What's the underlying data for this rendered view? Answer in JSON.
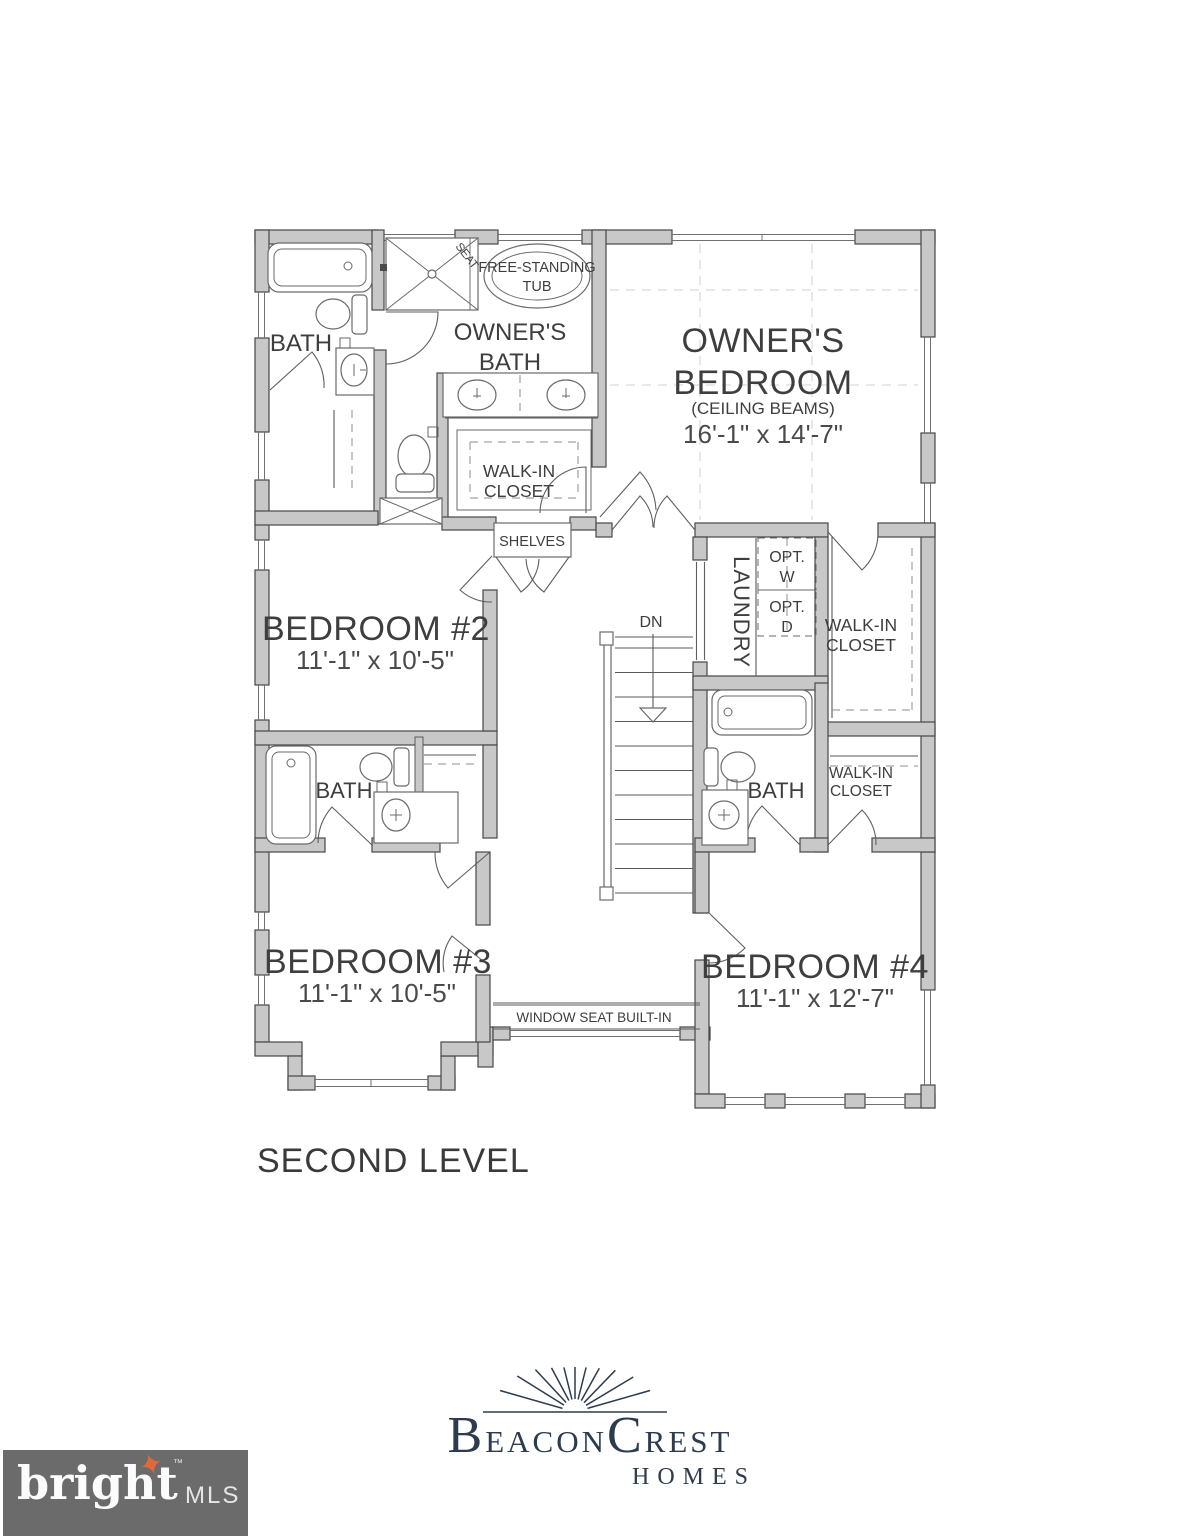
{
  "colors": {
    "ink": "#3e3e3e",
    "wall_fill": "#c8c8c8",
    "wall_stroke": "#474747",
    "logo_navy": "#2c3b4d",
    "mls_bar": "#6b6b6b",
    "mls_star": "#e0683c"
  },
  "plan": {
    "level_title": "SECOND LEVEL",
    "rooms": {
      "bath_top_left": {
        "label": "BATH"
      },
      "owners_bath": {
        "line1": "OWNER'S",
        "line2": "BATH",
        "tub_line1": "FREE-STANDING",
        "tub_line2": "TUB",
        "seat": "SEAT"
      },
      "owners_bedroom": {
        "line1": "OWNER'S",
        "line2": "BEDROOM",
        "note": "(CEILING BEAMS)",
        "dims": "16'-1\" x 14'-7\""
      },
      "owners_closet": {
        "line1": "WALK-IN",
        "line2": "CLOSET"
      },
      "shelves": {
        "label": "SHELVES"
      },
      "bedroom2": {
        "label": "BEDROOM #2",
        "dims": "11'-1\" x 10'-5\""
      },
      "laundry": {
        "label": "LAUNDRY",
        "opt_w_line1": "OPT.",
        "opt_w_line2": "W",
        "opt_d_line1": "OPT.",
        "opt_d_line2": "D"
      },
      "hall_closet": {
        "line1": "WALK-IN",
        "line2": "CLOSET"
      },
      "stairs": {
        "label": "DN"
      },
      "bath_right": {
        "label": "BATH"
      },
      "bedroom4_closet": {
        "line1": "WALK-IN",
        "line2": "CLOSET"
      },
      "bath_left": {
        "label": "BATH"
      },
      "bedroom3": {
        "label": "BEDROOM #3",
        "dims": "11'-1\" x 10'-5\""
      },
      "window_seat": {
        "label": "WINDOW SEAT BUILT-IN"
      },
      "bedroom4": {
        "label": "BEDROOM #4",
        "dims": "11'-1\" x 12'-7\""
      }
    }
  },
  "branding": {
    "beacon_initial": "B",
    "beacon_rest": "EACON",
    "crest_initial": "C",
    "crest_rest": "REST",
    "homes": "HOMES"
  },
  "footer": {
    "wordmark": "bright",
    "trademark": "™",
    "suffix": "MLS"
  }
}
